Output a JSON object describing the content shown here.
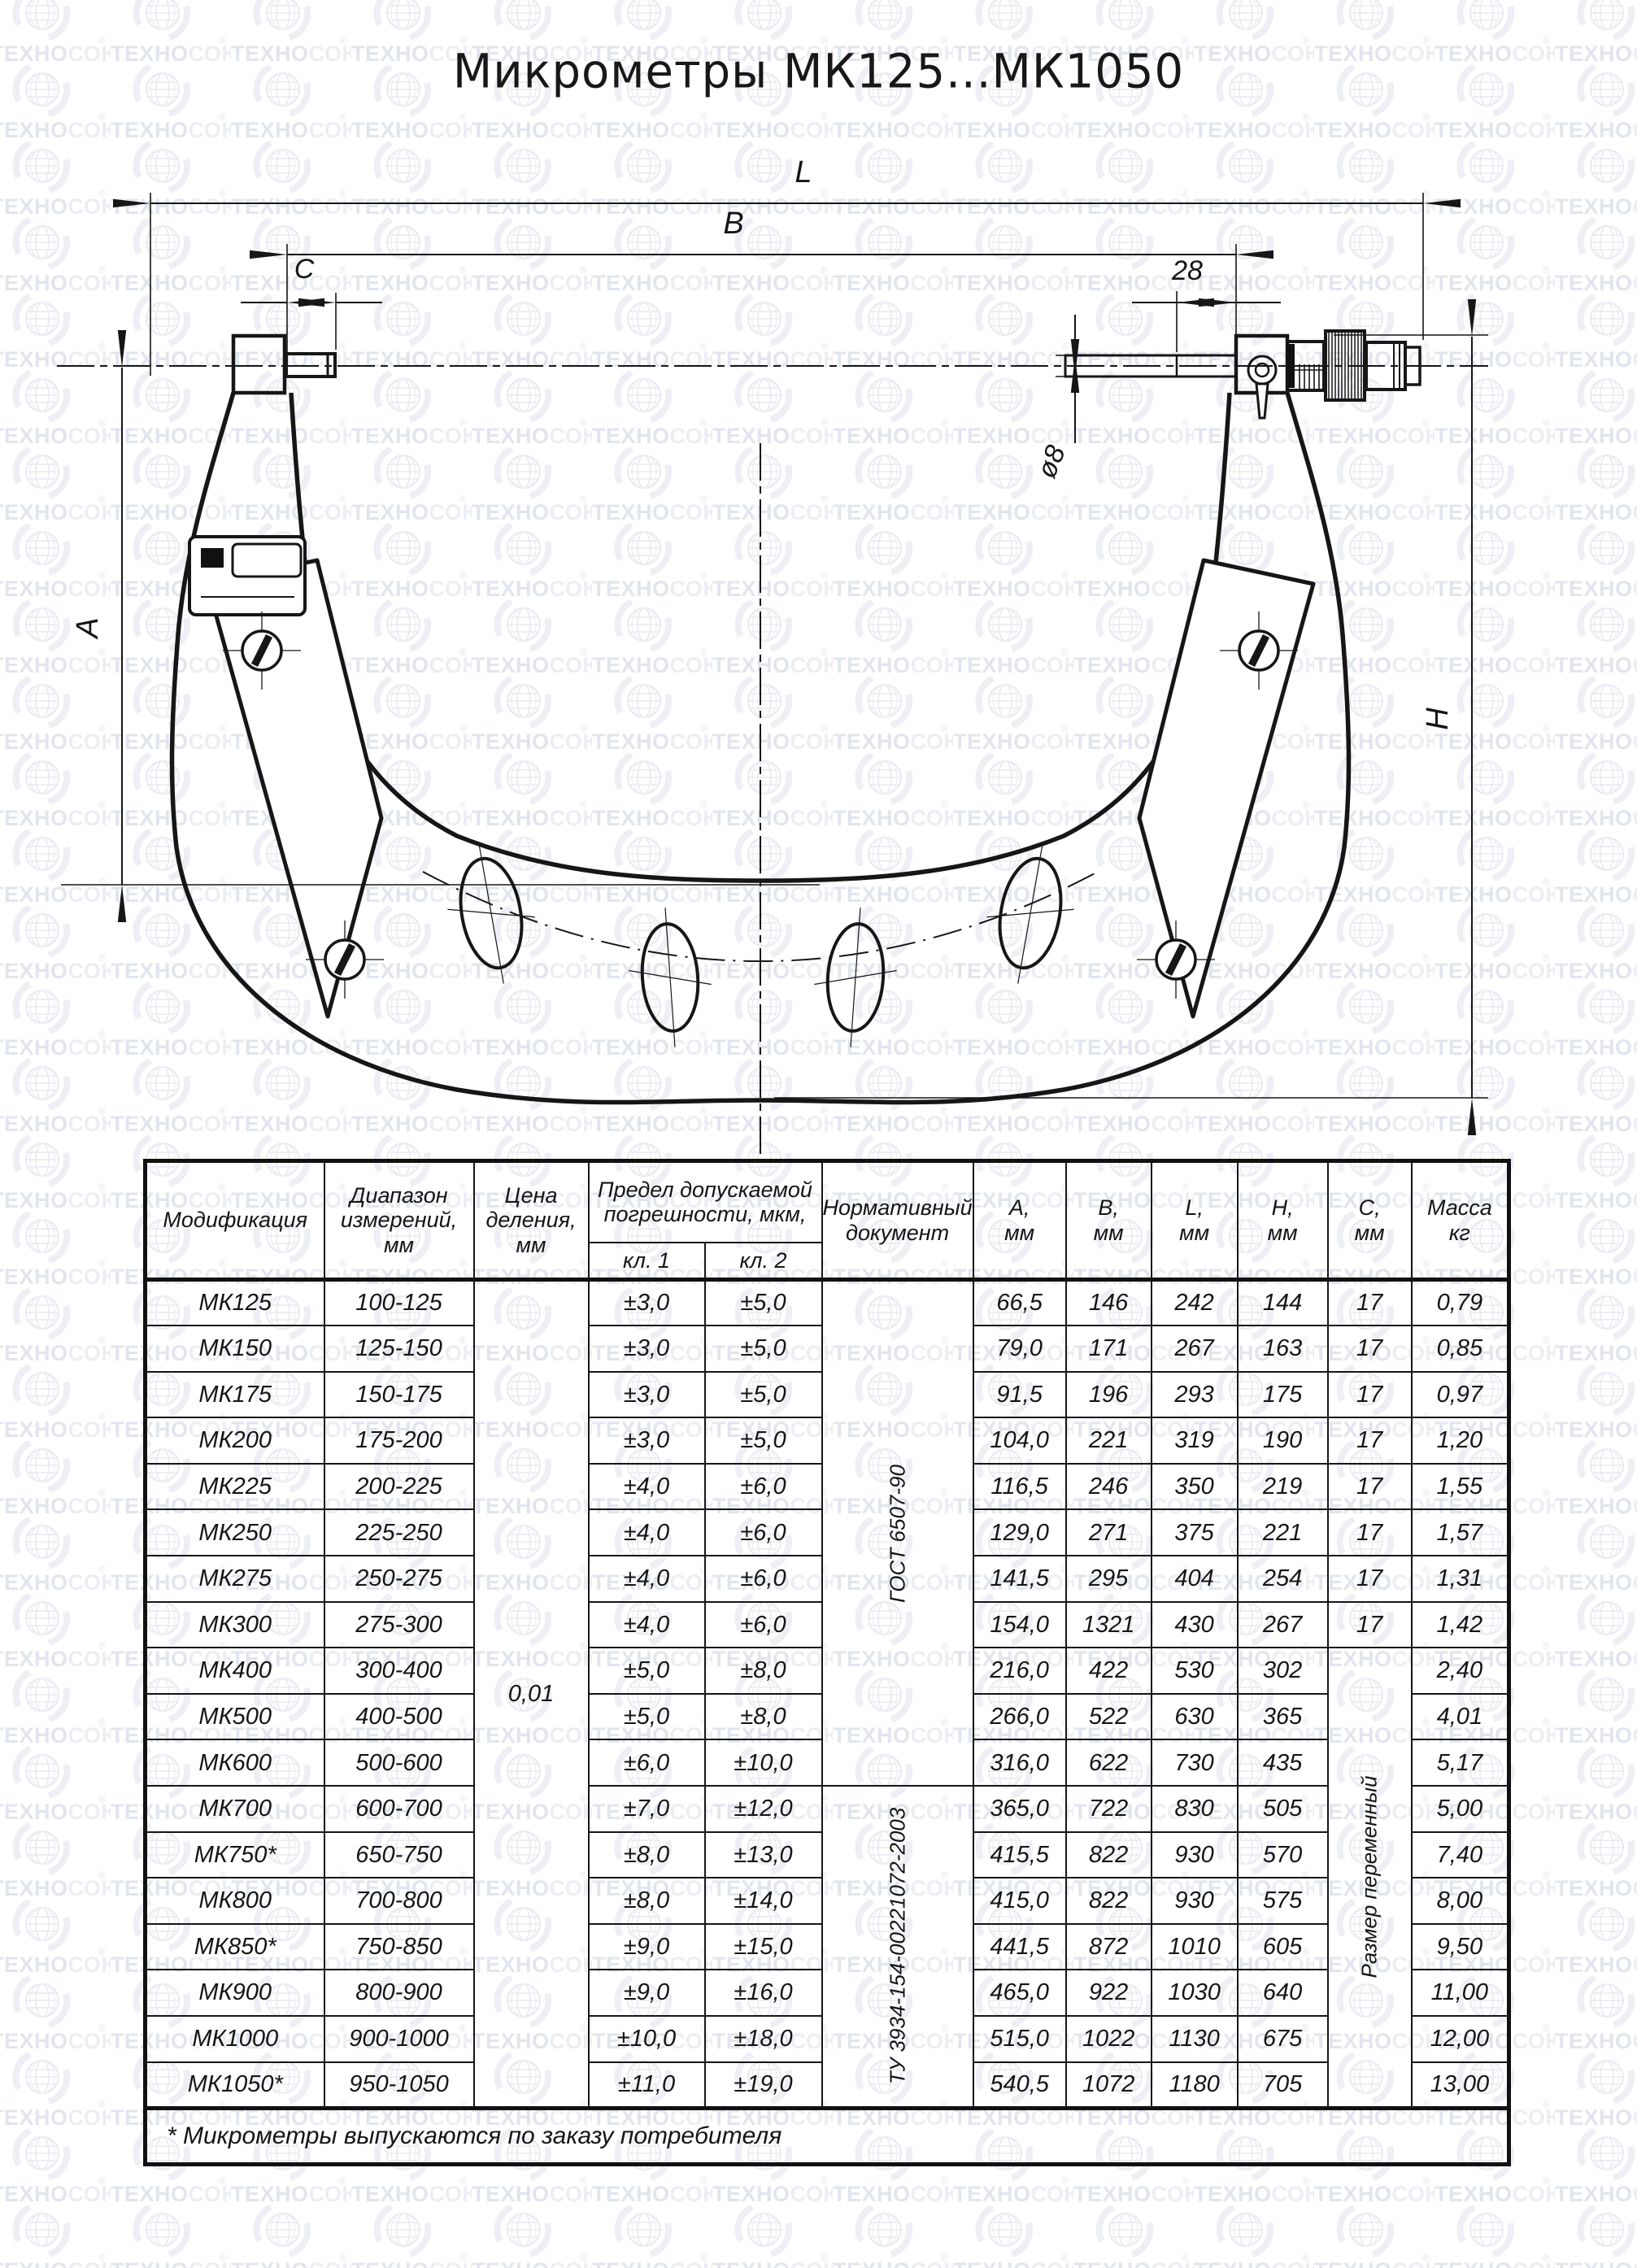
{
  "title": "Микрометры МК125...МК1050",
  "watermark": {
    "brand_bold": "ТЕХНО",
    "brand_light": "СОЮЗ",
    "reg": "®"
  },
  "drawing": {
    "labels": {
      "l": "L",
      "b": "B",
      "c": "C",
      "len28": "28",
      "dia8": "ø8",
      "a": "A",
      "h": "H"
    }
  },
  "table": {
    "headers": {
      "modification": "Модификация",
      "range": [
        "Диапазон",
        "измерений,",
        "мм"
      ],
      "division": [
        "Цена",
        "деления,",
        "мм"
      ],
      "error_limit": [
        "Предел допускаемой",
        "погрешности, мкм,"
      ],
      "class1": "кл. 1",
      "class2": "кл. 2",
      "norm_doc": [
        "Нормативный",
        "документ"
      ],
      "a": [
        "А,",
        "мм"
      ],
      "b": [
        "В,",
        "мм"
      ],
      "l": [
        "L,",
        "мм"
      ],
      "h": [
        "Н,",
        "мм"
      ],
      "c": [
        "С,",
        "мм"
      ],
      "mass": [
        "Масса",
        "кг"
      ]
    },
    "division_value": "0,01",
    "norm_docs": [
      {
        "label": "ГОСТ 6507-90",
        "rows": 11
      },
      {
        "label": "ТУ 3934-154-00221072-2003",
        "rows": 7
      }
    ],
    "c_variable_label": "Размер переменный",
    "rows": [
      [
        "МК125",
        "100-125",
        "±3,0",
        "±5,0",
        "66,5",
        "146",
        "242",
        "144",
        "17",
        "0,79"
      ],
      [
        "МК150",
        "125-150",
        "±3,0",
        "±5,0",
        "79,0",
        "171",
        "267",
        "163",
        "17",
        "0,85"
      ],
      [
        "МК175",
        "150-175",
        "±3,0",
        "±5,0",
        "91,5",
        "196",
        "293",
        "175",
        "17",
        "0,97"
      ],
      [
        "МК200",
        "175-200",
        "±3,0",
        "±5,0",
        "104,0",
        "221",
        "319",
        "190",
        "17",
        "1,20"
      ],
      [
        "МК225",
        "200-225",
        "±4,0",
        "±6,0",
        "116,5",
        "246",
        "350",
        "219",
        "17",
        "1,55"
      ],
      [
        "МК250",
        "225-250",
        "±4,0",
        "±6,0",
        "129,0",
        "271",
        "375",
        "221",
        "17",
        "1,57"
      ],
      [
        "МК275",
        "250-275",
        "±4,0",
        "±6,0",
        "141,5",
        "295",
        "404",
        "254",
        "17",
        "1,31"
      ],
      [
        "МК300",
        "275-300",
        "±4,0",
        "±6,0",
        "154,0",
        "1321",
        "430",
        "267",
        "17",
        "1,42"
      ],
      [
        "МК400",
        "300-400",
        "±5,0",
        "±8,0",
        "216,0",
        "422",
        "530",
        "302",
        null,
        "2,40"
      ],
      [
        "МК500",
        "400-500",
        "±5,0",
        "±8,0",
        "266,0",
        "522",
        "630",
        "365",
        null,
        "4,01"
      ],
      [
        "МК600",
        "500-600",
        "±6,0",
        "±10,0",
        "316,0",
        "622",
        "730",
        "435",
        null,
        "5,17"
      ],
      [
        "МК700",
        "600-700",
        "±7,0",
        "±12,0",
        "365,0",
        "722",
        "830",
        "505",
        null,
        "5,00"
      ],
      [
        "МК750*",
        "650-750",
        "±8,0",
        "±13,0",
        "415,5",
        "822",
        "930",
        "570",
        null,
        "7,40"
      ],
      [
        "МК800",
        "700-800",
        "±8,0",
        "±14,0",
        "415,0",
        "822",
        "930",
        "575",
        null,
        "8,00"
      ],
      [
        "МК850*",
        "750-850",
        "±9,0",
        "±15,0",
        "441,5",
        "872",
        "1010",
        "605",
        null,
        "9,50"
      ],
      [
        "МК900",
        "800-900",
        "±9,0",
        "±16,0",
        "465,0",
        "922",
        "1030",
        "640",
        null,
        "11,00"
      ],
      [
        "МК1000",
        "900-1000",
        "±10,0",
        "±18,0",
        "515,0",
        "1022",
        "1130",
        "675",
        null,
        "12,00"
      ],
      [
        "МК1050*",
        "950-1050",
        "±11,0",
        "±19,0",
        "540,5",
        "1072",
        "1180",
        "705",
        null,
        "13,00"
      ]
    ],
    "footnote": "* Микрометры выпускаются по заказу потребителя"
  }
}
